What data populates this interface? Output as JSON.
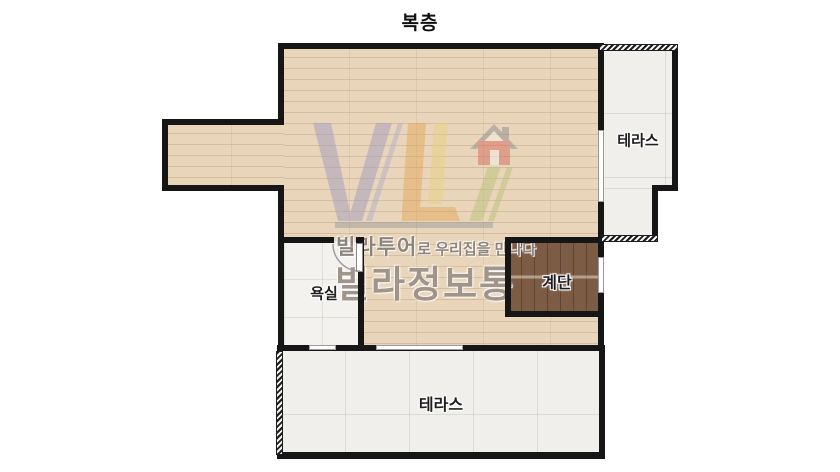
{
  "title": "복층",
  "rooms": {
    "terrace_right": {
      "label": "테라스"
    },
    "stairs": {
      "label": "계단"
    },
    "bathroom": {
      "label": "욕실"
    },
    "terrace_bottom": {
      "label": "테라스"
    },
    "main": {
      "label": ""
    }
  },
  "watermark": {
    "logo": "vl-house-logo",
    "tagline_strong": "빌라투어",
    "tagline_rest": "로 우리집을 만나다",
    "brand": "빌라정보통"
  },
  "colors": {
    "wood_floor": "#e8d5ba",
    "stair_wood": "#7c5c45",
    "terrace_tile": "#f0efeb",
    "bathroom_tile": "#f3f2ee",
    "wall": "#161616",
    "logo_purple": "#a49cc0",
    "logo_orange": "#e3a85c",
    "logo_yellow": "#ead37f",
    "logo_green": "#b9c377",
    "logo_red": "#d9685c",
    "watermark_text": "#897b6e"
  }
}
